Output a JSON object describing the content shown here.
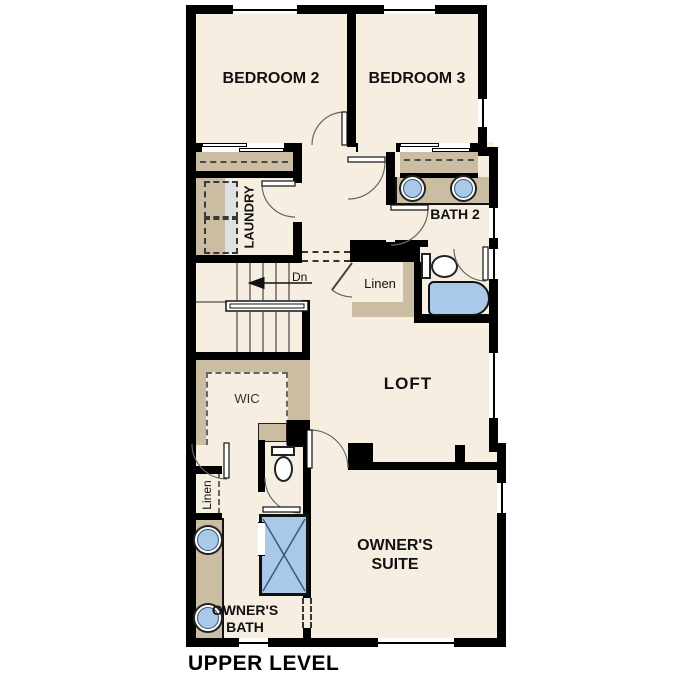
{
  "title": {
    "label": "UPPER LEVEL"
  },
  "rooms": {
    "bedroom2": {
      "label": "BEDROOM 2"
    },
    "bedroom3": {
      "label": "BEDROOM 3"
    },
    "laundry": {
      "label": "LAUNDRY"
    },
    "bath2": {
      "label": "BATH 2"
    },
    "linen_hall": {
      "label": "Linen"
    },
    "loft": {
      "label": "LOFT"
    },
    "wic": {
      "label": "WIC"
    },
    "linen_owner": {
      "label": "Linen"
    },
    "owners_bath": {
      "label": "OWNER'S BATH"
    },
    "owners_suite": {
      "label": "OWNER'S SUITE"
    }
  },
  "stairs": {
    "direction_label": "Dn"
  },
  "fixtures": {
    "sink": "sink-icon",
    "toilet": "toilet-icon",
    "bathtub": "bathtub-icon",
    "shower": "shower-icon",
    "washer_dryer": "washer-dryer-icon",
    "stairs": "stairs-icon",
    "door_swing": "door-swing-arc"
  },
  "colors": {
    "wall": "#000000",
    "floor": "#f6eee1",
    "cabinet": "#cbbda2",
    "fixture": "#aac9e8",
    "appliance": "#dde1e4"
  }
}
